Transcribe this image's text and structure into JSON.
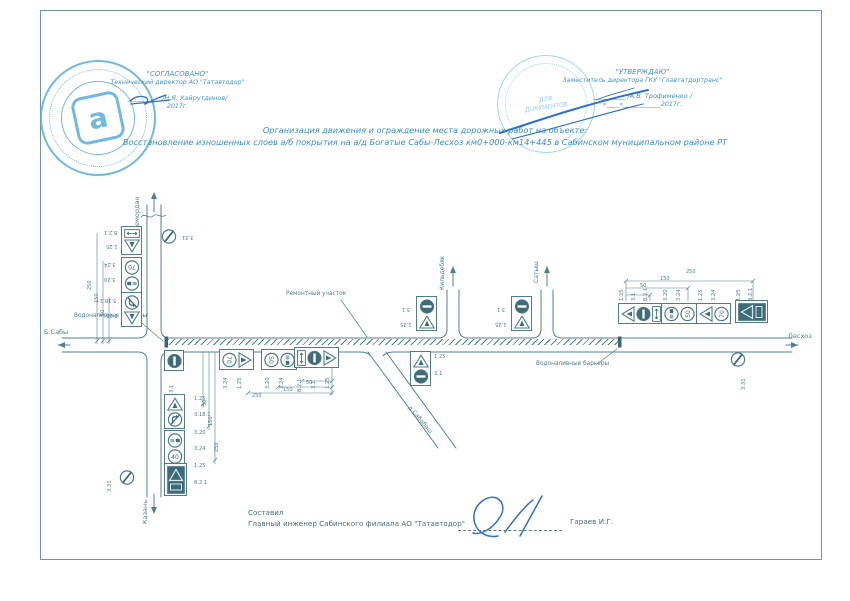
{
  "colors": {
    "ink": "#4f7d8c",
    "ink_dark": "#3f6b78",
    "stamp_blue": "#58aede",
    "pen_blue": "#2f6fd0",
    "header_blue": "#3f93c8"
  },
  "stamps": {
    "left": {
      "approve_word": "\"СОГЛАСОВАНО\"",
      "role": "Технический директор АО \"Татавтодор\"",
      "signature_line": "__________ /Н.Я. Хайрутдинов/",
      "year": "2017г.",
      "logo_letter": "а"
    },
    "right": {
      "approve_word": "\"УТВЕРЖДАЮ\"",
      "role": "Заместитель директора ГКУ \"Главтатдортранс\"",
      "signature_line": "__________ /А.В. Трофименко /",
      "year": "«____»____________2017г.",
      "seal_line1": "ДЛЯ",
      "seal_line2": "ДОКУМЕНТОВ"
    }
  },
  "title": {
    "line1": "Организация движения и ограждение места дорожных работ на объекте:",
    "line2": "Восстановление изношенных слоев а/б покрытия на а/д Богатые Сабы-Лесхоз км0+000-км14+445 в Сабинском муниципальном районе РТ"
  },
  "footer": {
    "made_by": "Составил",
    "role": "Главный инженер Сабинского филиала АО \"Татавтодор\"",
    "name": "Гараев И.Г."
  },
  "diagram": {
    "texts": [
      {
        "x": 134,
        "y": 233,
        "t": "Шемордан",
        "r": -90,
        "s": 6.5
      },
      {
        "x": 142,
        "y": 524,
        "t": "Казань",
        "r": -90,
        "s": 6.5
      },
      {
        "x": 44,
        "y": 329,
        "t": "Б.Сабы",
        "s": 6.5
      },
      {
        "x": 788,
        "y": 333,
        "t": "Лесхоз",
        "s": 6.5
      },
      {
        "x": 440,
        "y": 290,
        "t": "Кильдебяк",
        "r": -90,
        "s": 6
      },
      {
        "x": 534,
        "y": 283,
        "t": "Сатыш",
        "r": -90,
        "s": 6
      },
      {
        "x": 411,
        "y": 405,
        "t": "д.Сабабаш",
        "r": 50,
        "s": 6
      },
      {
        "x": 74,
        "y": 314,
        "t": "Водоналивные барьеры",
        "s": 5.8
      },
      {
        "x": 536,
        "y": 362,
        "t": "Водоналивные барьеры",
        "s": 5.8
      },
      {
        "x": 286,
        "y": 292,
        "t": "Ремонтный участок",
        "s": 5.8
      },
      {
        "x": 104,
        "y": 229,
        "t": "8.2.1",
        "r": 180
      },
      {
        "x": 106,
        "y": 243,
        "t": "1.25",
        "r": 180
      },
      {
        "x": 104,
        "y": 261,
        "t": "3.24",
        "r": 180
      },
      {
        "x": 104,
        "y": 276,
        "t": "3.20",
        "r": 180
      },
      {
        "x": 100,
        "y": 297,
        "t": "3.18.2",
        "r": 180
      },
      {
        "x": 106,
        "y": 312,
        "t": "1.25",
        "r": 180
      },
      {
        "x": 182,
        "y": 234,
        "t": "3.31",
        "r": 180
      },
      {
        "x": 194,
        "y": 397,
        "t": "1.25"
      },
      {
        "x": 194,
        "y": 413,
        "t": "3.18.1"
      },
      {
        "x": 194,
        "y": 431,
        "t": "3.20"
      },
      {
        "x": 194,
        "y": 447,
        "t": "3.24"
      },
      {
        "x": 194,
        "y": 464,
        "t": "1.25"
      },
      {
        "x": 194,
        "y": 481,
        "t": "8.2.1"
      },
      {
        "x": 108,
        "y": 492,
        "t": "3.31",
        "r": -90
      },
      {
        "x": 170,
        "y": 393,
        "t": "3.1",
        "r": -90
      },
      {
        "x": 224,
        "y": 389,
        "t": "3.24",
        "r": -90
      },
      {
        "x": 238,
        "y": 389,
        "t": "1.25",
        "r": -90
      },
      {
        "x": 266,
        "y": 389,
        "t": "3.20",
        "r": -90
      },
      {
        "x": 280,
        "y": 389,
        "t": "3.24",
        "r": -90
      },
      {
        "x": 298,
        "y": 392,
        "t": "8.2.1",
        "r": -90
      },
      {
        "x": 312,
        "y": 389,
        "t": "3.1",
        "r": -90
      },
      {
        "x": 326,
        "y": 389,
        "t": "1.25",
        "r": -90
      },
      {
        "x": 306,
        "y": 381,
        "t": "50",
        "s": 5
      },
      {
        "x": 283,
        "y": 388,
        "t": "150",
        "s": 5
      },
      {
        "x": 252,
        "y": 394,
        "t": "250",
        "s": 5
      },
      {
        "x": 402,
        "y": 306,
        "t": "3.1",
        "r": 180
      },
      {
        "x": 400,
        "y": 321,
        "t": "1.25",
        "r": 180
      },
      {
        "x": 497,
        "y": 306,
        "t": "3.1",
        "r": 180
      },
      {
        "x": 495,
        "y": 321,
        "t": "1.25",
        "r": 180
      },
      {
        "x": 434,
        "y": 355,
        "t": "1.25"
      },
      {
        "x": 434,
        "y": 372,
        "t": "3.1"
      },
      {
        "x": 620,
        "y": 301,
        "t": "1.25",
        "r": -90
      },
      {
        "x": 632,
        "y": 301,
        "t": "3.1",
        "r": -90
      },
      {
        "x": 644,
        "y": 301,
        "t": "8.2.1",
        "r": -90
      },
      {
        "x": 664,
        "y": 301,
        "t": "3.20",
        "r": -90
      },
      {
        "x": 677,
        "y": 301,
        "t": "3.24",
        "r": -90
      },
      {
        "x": 699,
        "y": 301,
        "t": "1.25",
        "r": -90
      },
      {
        "x": 712,
        "y": 301,
        "t": "3.24",
        "r": -90
      },
      {
        "x": 737,
        "y": 301,
        "t": "1.25",
        "r": -90
      },
      {
        "x": 749,
        "y": 301,
        "t": "8.2.1",
        "r": -90
      },
      {
        "x": 640,
        "y": 284,
        "t": "50",
        "s": 5
      },
      {
        "x": 660,
        "y": 277,
        "t": "150",
        "s": 5
      },
      {
        "x": 686,
        "y": 270,
        "t": "250",
        "s": 5
      },
      {
        "x": 742,
        "y": 390,
        "t": "3.31",
        "r": -90
      },
      {
        "x": 88,
        "y": 290,
        "t": "250",
        "r": -90,
        "s": 5
      },
      {
        "x": 95,
        "y": 303,
        "t": "150",
        "r": -90,
        "s": 5
      },
      {
        "x": 101,
        "y": 316,
        "t": "50",
        "r": -90,
        "s": 5
      },
      {
        "x": 203,
        "y": 406,
        "t": "50",
        "r": -90,
        "s": 5
      },
      {
        "x": 209,
        "y": 426,
        "t": "150",
        "r": -90,
        "s": 5
      },
      {
        "x": 215,
        "y": 452,
        "t": "250",
        "r": -90,
        "s": 5
      }
    ],
    "sign_groups": [
      {
        "x": 121,
        "y": 226,
        "dir": "col",
        "irot": 180,
        "items": [
          "plate821",
          "w125"
        ]
      },
      {
        "x": 121,
        "y": 257,
        "dir": "col",
        "irot": 180,
        "items": [
          "s70",
          "c320"
        ]
      },
      {
        "x": 121,
        "y": 292,
        "dir": "col",
        "irot": 180,
        "items": [
          "c3182",
          "w125"
        ]
      },
      {
        "x": 161,
        "y": 229,
        "dir": "col",
        "irot": 0,
        "frame": false,
        "items": [
          "c331"
        ]
      },
      {
        "x": 164,
        "y": 350,
        "dir": "col",
        "irot": 90,
        "items": [
          "c31"
        ]
      },
      {
        "x": 219,
        "y": 349,
        "dir": "row",
        "irot": 90,
        "items": [
          "s70",
          "w125"
        ]
      },
      {
        "x": 261,
        "y": 349,
        "dir": "row",
        "irot": 90,
        "items": [
          "s50",
          "c320"
        ]
      },
      {
        "x": 294,
        "y": 347,
        "dir": "row",
        "irot": 90,
        "items": [
          "plate821",
          "c31",
          "w125"
        ]
      },
      {
        "x": 416,
        "y": 296,
        "dir": "col",
        "irot": 0,
        "items": [
          "c31",
          "w125"
        ]
      },
      {
        "x": 511,
        "y": 296,
        "dir": "col",
        "irot": 0,
        "items": [
          "c31",
          "w125"
        ]
      },
      {
        "x": 410,
        "y": 351,
        "dir": "col",
        "irot": 0,
        "items": [
          "w125",
          "c31"
        ]
      },
      {
        "x": 618,
        "y": 303,
        "dir": "row",
        "irot": -90,
        "items": [
          "w125",
          "c31",
          "plate821"
        ]
      },
      {
        "x": 661,
        "y": 303,
        "dir": "row",
        "irot": -90,
        "items": [
          "c320",
          "s50"
        ]
      },
      {
        "x": 696,
        "y": 303,
        "dir": "row",
        "irot": -90,
        "items": [
          "w125",
          "s70"
        ]
      },
      {
        "x": 735,
        "y": 300,
        "dir": "row",
        "irot": -90,
        "items": [
          "shield"
        ]
      },
      {
        "x": 164,
        "y": 394,
        "dir": "col",
        "irot": 0,
        "items": [
          "w125",
          "c3181"
        ]
      },
      {
        "x": 164,
        "y": 430,
        "dir": "col",
        "irot": 0,
        "items": [
          "c320",
          "s40"
        ]
      },
      {
        "x": 164,
        "y": 463,
        "dir": "col",
        "irot": 0,
        "items": [
          "shield"
        ]
      },
      {
        "x": 119,
        "y": 470,
        "dir": "col",
        "irot": 0,
        "frame": false,
        "items": [
          "c331"
        ]
      },
      {
        "x": 730,
        "y": 352,
        "dir": "col",
        "irot": 0,
        "frame": false,
        "items": [
          "c331"
        ]
      }
    ]
  }
}
